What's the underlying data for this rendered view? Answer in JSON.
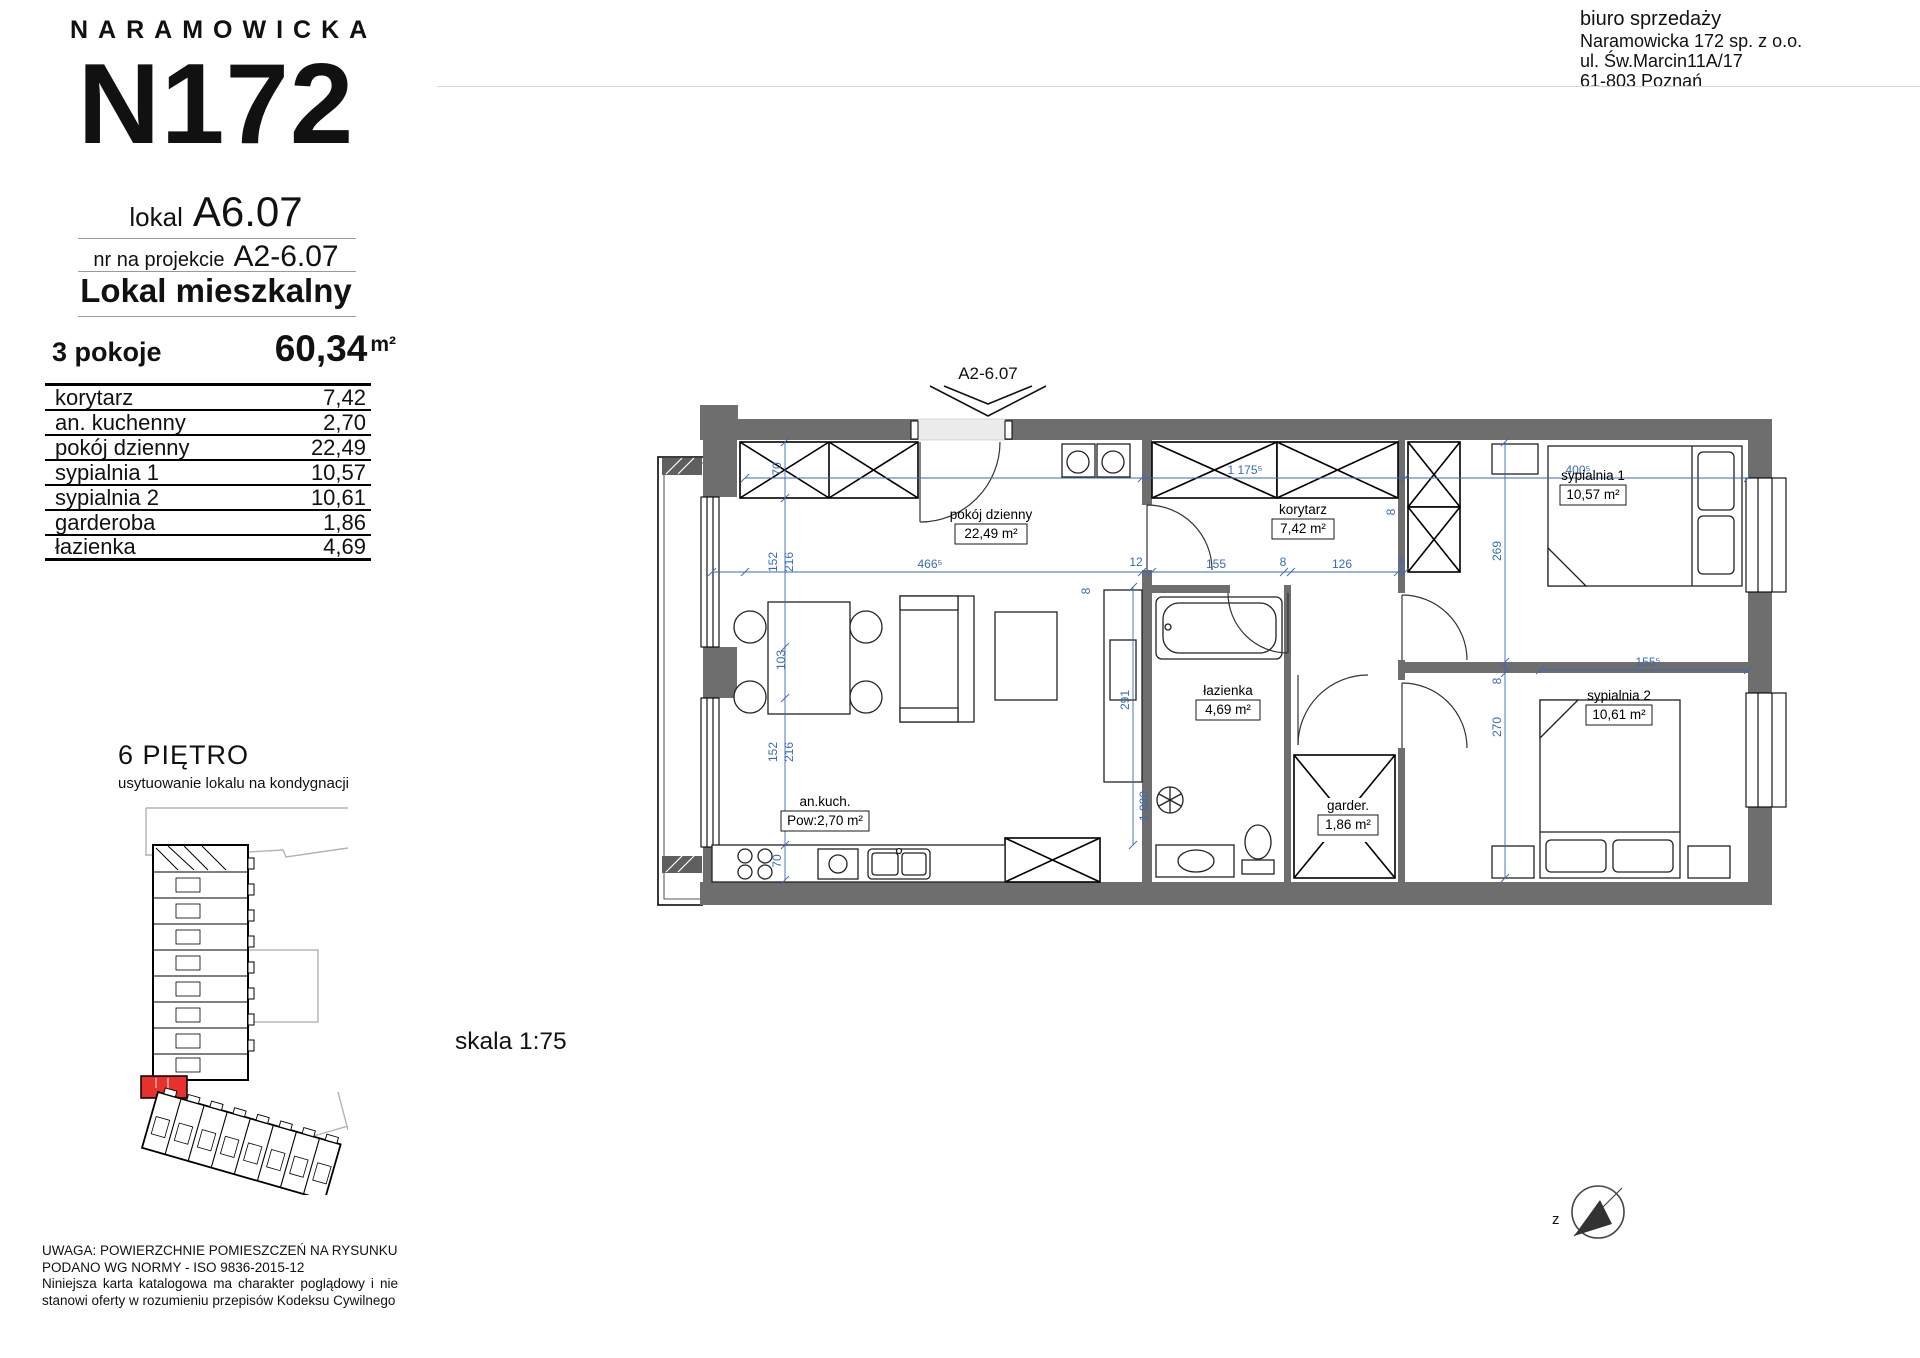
{
  "brand": {
    "name": "NARAMOWICKA",
    "logo": "N172"
  },
  "unit": {
    "lokal_label": "lokal",
    "lokal_no": "A6.07",
    "project_label": "nr na projekcie",
    "project_no": "A2-6.07",
    "type": "Lokal mieszkalny"
  },
  "summary": {
    "rooms": "3 pokoje",
    "area": "60,34",
    "area_unit": "m²"
  },
  "room_table": [
    {
      "name": "korytarz",
      "area": "7,42"
    },
    {
      "name": "an. kuchenny",
      "area": "2,70"
    },
    {
      "name": "pokój dzienny",
      "area": "22,49"
    },
    {
      "name": "sypialnia 1",
      "area": "10,57"
    },
    {
      "name": "sypialnia 2",
      "area": "10,61"
    },
    {
      "name": "garderoba",
      "area": "1,86"
    },
    {
      "name": "łazienka",
      "area": "4,69"
    }
  ],
  "floor_section": {
    "title": "6 PIĘTRO",
    "subtitle": "usytuowanie lokalu na kondygnacji"
  },
  "sales_office": {
    "line1": "biuro sprzedaży",
    "line2": "Naramowicka 172 sp. z o.o.",
    "line3": "ul. Św.Marcin11A/17",
    "line4": "61-803 Poznań"
  },
  "disclaimer": {
    "line1": "UWAGA: POWIERZCHNIE POMIESZCZEŃ NA RYSUNKU",
    "line2": "PODANO WG NORMY - ISO 9836-2015-12",
    "line3": "Niniejsza karta katalogowa ma charakter poglądowy i nie stanowi oferty w rozumieniu przepisów Kodeksu Cywilnego"
  },
  "plan": {
    "marker": "A2-6.07",
    "scale": "skala 1:75",
    "compass": "z",
    "rooms": {
      "living": {
        "name": "pokój dzienny",
        "area": "22,49 m²"
      },
      "hall": {
        "name": "korytarz",
        "area": "7,42 m²"
      },
      "bath": {
        "name": "łazienka",
        "area": "4,69 m²"
      },
      "bedroom1": {
        "name": "sypialnia 1",
        "area": "10,57 m²"
      },
      "bedroom2": {
        "name": "sypialnia 2",
        "area": "10,61 m²"
      },
      "wardrobe": {
        "name": "garder.",
        "area": "1,86 m²"
      },
      "kitchen": {
        "name": "an.kuch.",
        "area": "Pow:2,70 m²"
      }
    },
    "dims": {
      "d70a": "70",
      "d152a": "152",
      "d216a": "216",
      "d103": "103",
      "d152b": "152",
      "d216b": "216",
      "d70b": "70",
      "d466": "466⁵",
      "d12": "12",
      "d155": "155",
      "d8a": "8",
      "d126": "126",
      "d8b": "8",
      "d1175": "1 175⁵",
      "d400": "400⁵",
      "d269": "269",
      "d8c": "8",
      "d270": "270",
      "d155b": "155⁵",
      "d291": "291",
      "d1020": "1 020",
      "d8d": "8",
      "d8e": "8"
    }
  },
  "colors": {
    "accent_red": "#e8312a",
    "dim_blue": "#3a6ab5",
    "wall_gray": "#6e6e6e"
  }
}
